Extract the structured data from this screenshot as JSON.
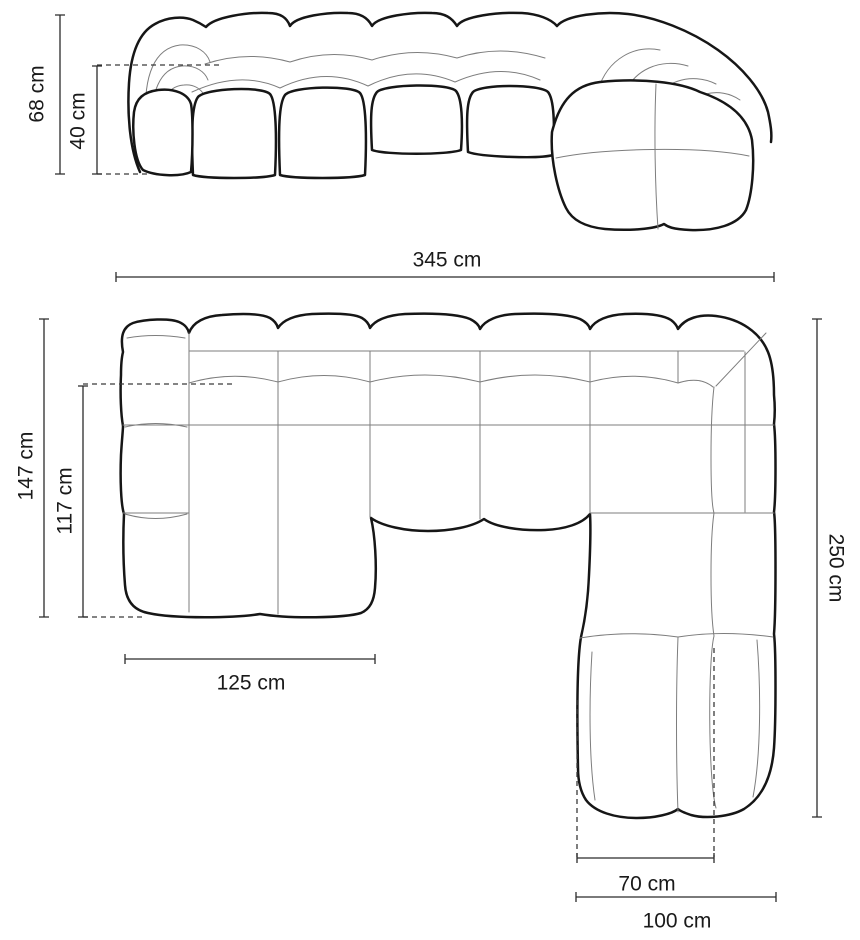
{
  "diagram": {
    "type": "sofa-dimension-drawing",
    "unit": "cm",
    "colors": {
      "background": "#ffffff",
      "outline": "#161616",
      "seam": "#7d7d7d",
      "dimension": "#2b2b2b"
    },
    "views": {
      "front": {
        "name": "front elevation",
        "dimensions": {
          "total_height": {
            "label": "68 cm",
            "value": 68
          },
          "seat_height": {
            "label": "40 cm",
            "value": 40
          },
          "total_width": {
            "label": "345 cm",
            "value": 345
          }
        }
      },
      "top": {
        "name": "top plan view",
        "dimensions": {
          "left_side_depth": {
            "label": "147 cm",
            "value": 147
          },
          "left_seat_depth": {
            "label": "117 cm",
            "value": 117
          },
          "left_section_width": {
            "label": "125 cm",
            "value": 125
          },
          "right_side_depth": {
            "label": "250 cm",
            "value": 250
          },
          "chaise_seat_width": {
            "label": "70 cm",
            "value": 70
          },
          "chaise_total_width": {
            "label": "100 cm",
            "value": 100
          }
        }
      }
    }
  }
}
